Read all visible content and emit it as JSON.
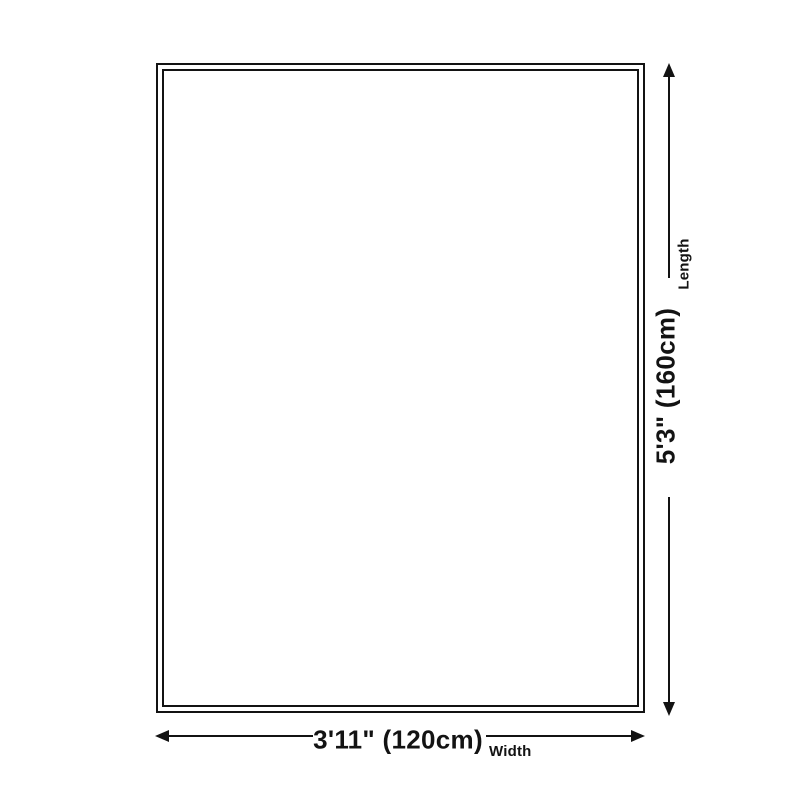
{
  "diagram": {
    "type": "product-dimension-diagram",
    "background_color": "#ffffff",
    "line_color": "#131313",
    "rug": {
      "border_style": "double-outline rectangle"
    },
    "length": {
      "label": "Length",
      "value": "5'3\" (160cm)"
    },
    "width": {
      "label": "Width",
      "value": "3'11\" (120cm)"
    }
  }
}
